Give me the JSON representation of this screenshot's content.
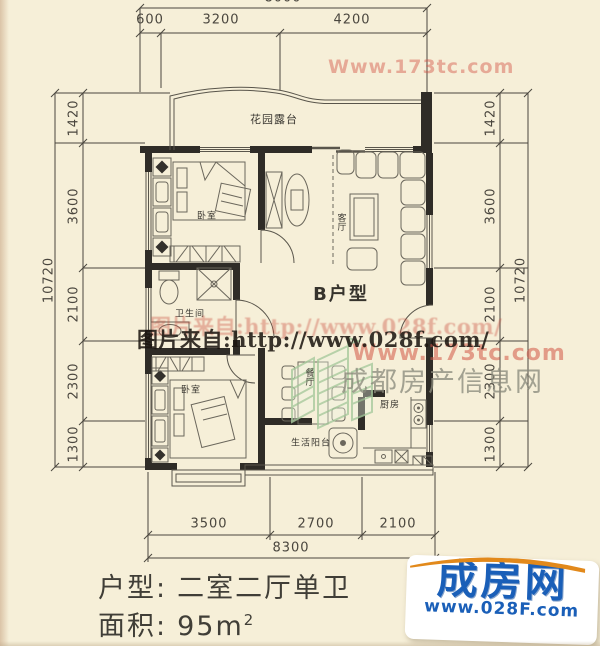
{
  "dimensions": {
    "top_total": "8000",
    "top": [
      "600",
      "3200",
      "4200"
    ],
    "left_total": "10720",
    "left": [
      "1420",
      "3600",
      "2100",
      "2300",
      "1300"
    ],
    "right_total": "10720",
    "right": [
      "1420",
      "3600",
      "2100",
      "2300",
      "1300"
    ],
    "bottom": [
      "3500",
      "2700",
      "2100"
    ],
    "bottom_total": "8300"
  },
  "plan": {
    "unit_label": "B户型",
    "rooms": [
      {
        "id": "garden-terrace",
        "label": "花园露台"
      },
      {
        "id": "bedroom-upper",
        "label": "卧室"
      },
      {
        "id": "living-room",
        "label": "客厅"
      },
      {
        "id": "bathroom",
        "label": "卫生间"
      },
      {
        "id": "bedroom-lower",
        "label": "卧室"
      },
      {
        "id": "dining-room",
        "label": "餐厅"
      },
      {
        "id": "kitchen",
        "label": "厨房"
      },
      {
        "id": "service-balcony",
        "label": "生活阳台"
      }
    ]
  },
  "watermarks": {
    "source_line": "图片来自:http://www.028f.com/",
    "source_line_echo": "图片来自:http://www.028f.com/",
    "site_red_mid": "Www.173tc.com",
    "site_red_top": "Www.173tc.com",
    "gray_site": "成都房产信息网"
  },
  "title_block": {
    "type_label": "户型:",
    "type_value": "二室二厅单卫",
    "area_label": "面积:",
    "area_value": "95m",
    "area_sup": "2"
  },
  "logo": {
    "name": "成房网",
    "url": "www.028F.com"
  },
  "colors": {
    "background": "#f6efd8",
    "wall": "#2f2c27",
    "logo_blue": "#1a5fb8",
    "logo_orange": "#e2891b",
    "watermark_red": "#d25546",
    "watermark_gray": "#8c8c7c",
    "watermark_green": "#a8ca9e"
  }
}
